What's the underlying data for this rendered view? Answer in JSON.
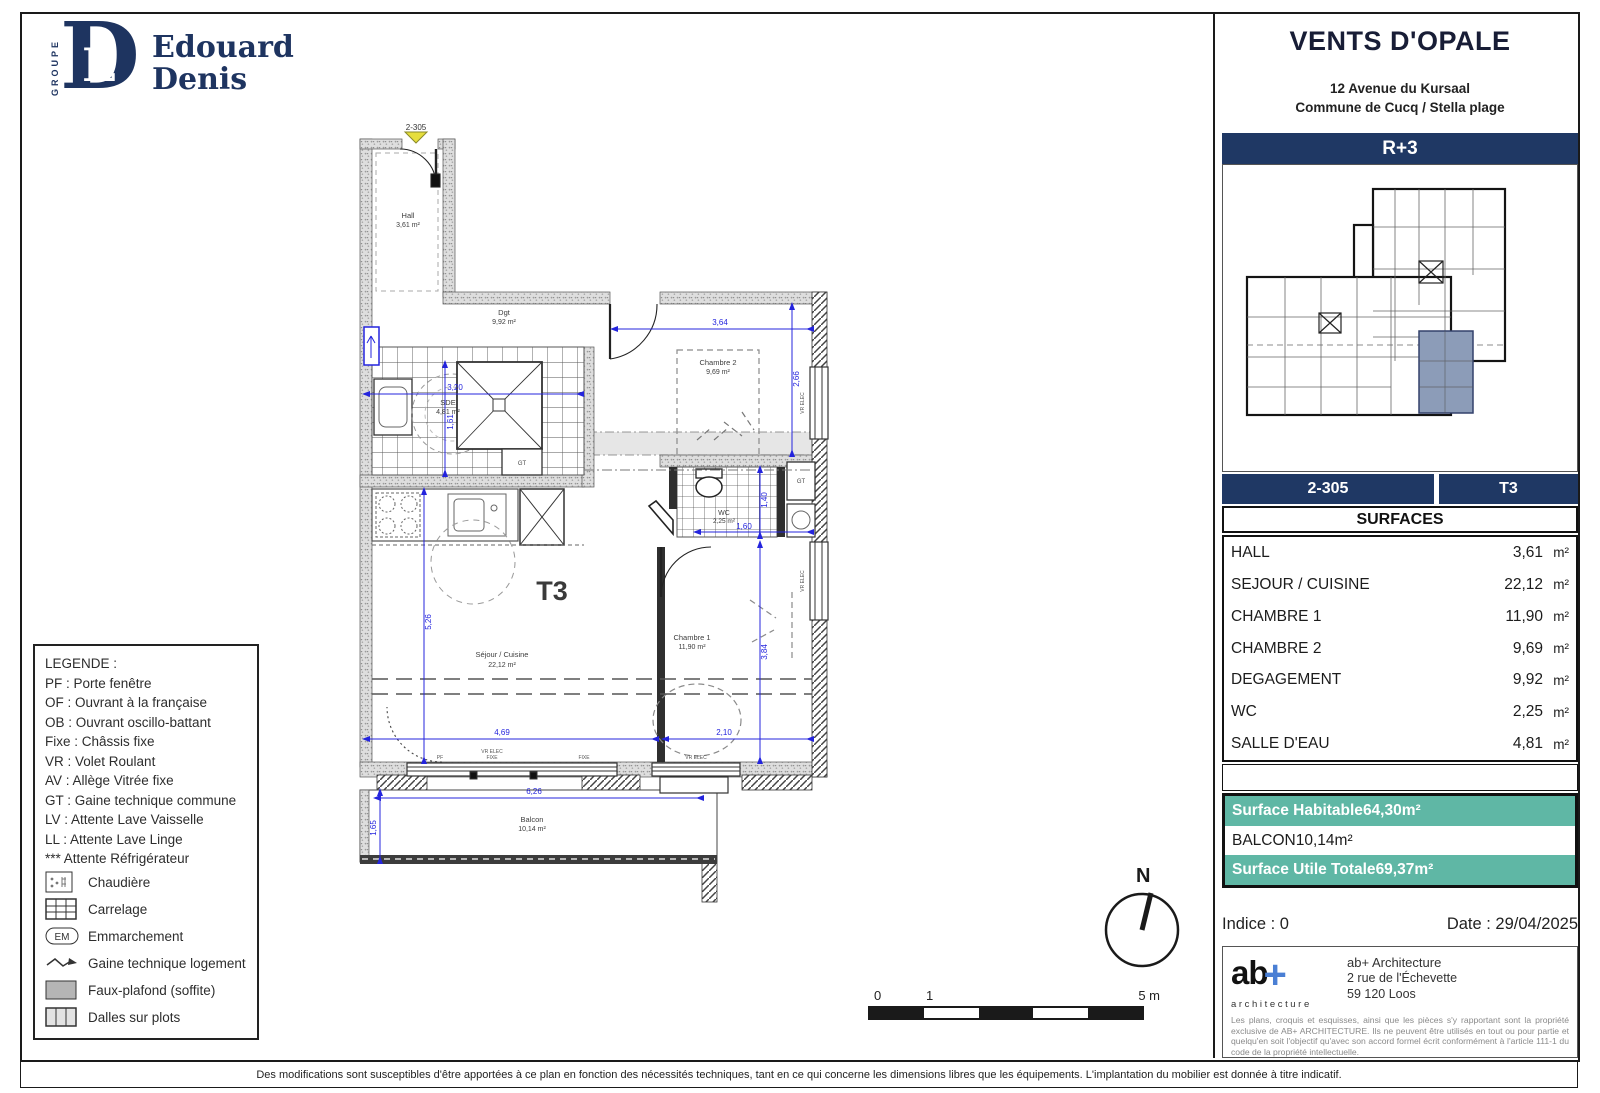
{
  "logo": {
    "groupe": "GROUPE",
    "monogram_d": "D",
    "monogram_e": "E",
    "line1": "Edouard",
    "line2": "Denis"
  },
  "project": {
    "title": "VENTS D'OPALE",
    "address_line1": "12 Avenue du Kursaal",
    "address_line2": "Commune de Cucq / Stella plage",
    "floor": "R+3",
    "unit": "2-305",
    "type": "T3"
  },
  "surfaces": {
    "header": "SURFACES",
    "rows": [
      {
        "label": "HALL",
        "value": "3,61",
        "unit": "m²"
      },
      {
        "label": "SEJOUR / CUISINE",
        "value": "22,12",
        "unit": "m²"
      },
      {
        "label": "CHAMBRE 1",
        "value": "11,90",
        "unit": "m²"
      },
      {
        "label": "CHAMBRE 2",
        "value": "9,69",
        "unit": "m²"
      },
      {
        "label": "DEGAGEMENT",
        "value": "9,92",
        "unit": "m²"
      },
      {
        "label": "WC",
        "value": "2,25",
        "unit": "m²"
      },
      {
        "label": "SALLE D'EAU",
        "value": "4,81",
        "unit": "m²"
      }
    ]
  },
  "totals": {
    "rows": [
      {
        "label": "Surface Habitable",
        "value": "64,30",
        "unit": "m²"
      },
      {
        "label": "BALCON",
        "value": "10,14",
        "unit": "m²"
      },
      {
        "label": "Surface Utile Totale",
        "value": "69,37",
        "unit": "m²"
      }
    ]
  },
  "meta": {
    "indice": "Indice : 0",
    "date": "Date : 29/04/2025"
  },
  "architect": {
    "logo_main": "ab",
    "logo_plus": "+",
    "logo_sub": "architecture",
    "name": "ab+ Architecture",
    "address1": "2 rue de l'Échevette",
    "address2": "59 120 Loos",
    "notice": "Les plans, croquis et esquisses, ainsi que les pièces s'y rapportant sont la propriété exclusive de AB+ ARCHITECTURE. Ils ne peuvent être utilisés en tout ou pour partie et quelqu'en soit l'objectif qu'avec son accord formel écrit conformément à l'article 111-1 du code de la propriété intellectuelle."
  },
  "legend": {
    "title": "LEGENDE :",
    "abbr": [
      "PF : Porte fenêtre",
      "OF : Ouvrant à la française",
      "OB : Ouvrant oscillo-battant",
      "Fixe : Châssis fixe",
      "VR : Volet Roulant",
      "AV : Allège Vitrée fixe",
      "GT : Gaine technique commune",
      "LV : Attente Lave Vaisselle",
      "LL : Attente Lave Linge",
      "*** Attente Réfrigérateur"
    ],
    "em_badge": "EM",
    "symbols": [
      {
        "label": "Chaudière"
      },
      {
        "label": "Carrelage"
      },
      {
        "label": "Emmarchement"
      },
      {
        "label": "Gaine technique logement"
      },
      {
        "label": "Faux-plafond (soffite)"
      },
      {
        "label": "Dalles sur plots"
      }
    ]
  },
  "plan": {
    "unit_marker": "2-305",
    "type_label": "T3",
    "rooms": {
      "hall": {
        "name": "Hall",
        "area": "3,61 m²"
      },
      "dgt": {
        "name": "Dgt",
        "area": "9,92 m²"
      },
      "sde": {
        "name": "SDE",
        "area": "4,81 m²"
      },
      "chambre2": {
        "name": "Chambre 2",
        "area": "9,69 m²"
      },
      "sejour": {
        "name": "Séjour / Cuisine",
        "area": "22,12 m²"
      },
      "chambre1": {
        "name": "Chambre 1",
        "area": "11,90 m²"
      },
      "wc": {
        "name": "WC",
        "area": "2,25 m²"
      },
      "balcon": {
        "name": "Balcon",
        "area": "10,14 m²"
      }
    },
    "dims": {
      "d364": "3,64",
      "d266": "2,66",
      "d320": "3,20",
      "d161": "1,61",
      "d526": "5,26",
      "d469": "4,69",
      "d210": "2,10",
      "d384": "3,84",
      "d140": "1,40",
      "d160": "1,60",
      "d626": "6,26",
      "d165": "1,65"
    },
    "tags": {
      "gt": "GT",
      "vr_elec": "VR ELEC",
      "pf": "PF",
      "fixe": "FIXE"
    }
  },
  "north": {
    "label": "N"
  },
  "scale_bar": {
    "zero": "0",
    "one": "1",
    "five": "5 m"
  },
  "page": {
    "disclaimer": "Des modifications sont susceptibles d'être apportées à ce plan en fonction des nécessités techniques, tant en ce qui concerne les dimensions libres que les équipements. L'implantation du mobilier est donnée à titre indicatif."
  }
}
